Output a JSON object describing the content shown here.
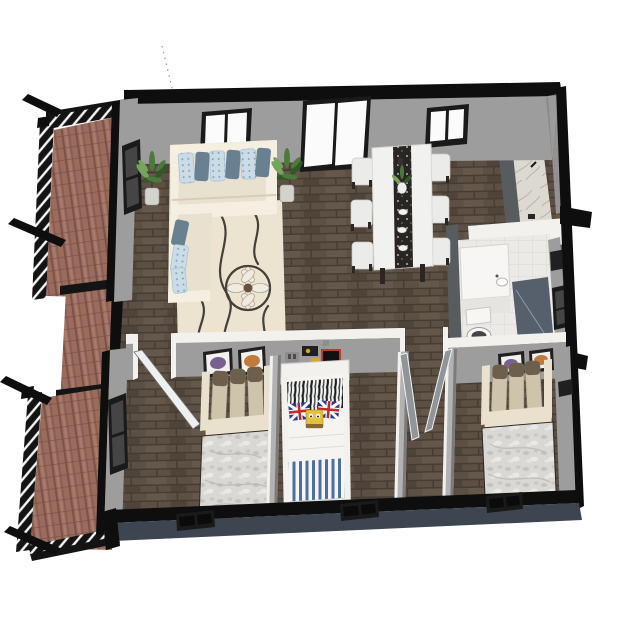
{
  "meta": {
    "description": "3D isometric rendered floor plan of a small apartment, viewed from above on a white background",
    "view": "axonometric top-down 3D render"
  },
  "palette": {
    "bg": "#ffffff",
    "wall_cap": "#0e0e0e",
    "wall_face": "#9d9d9d",
    "wall_face_dark": "#7b7b7b",
    "wall_white": "#f2f1ee",
    "floor_wood": "#5c5044",
    "floor_wood_dark": "#453b31",
    "floor_wood_light": "#6e6052",
    "balcony_floor": "#9a6c5e",
    "balcony_floor_dark": "#764c41",
    "balcony_floor_light": "#b08273",
    "railing": "#141414",
    "railing_slat": "#f7f7f7",
    "exterior_bottom": "#3d4650",
    "window_frame": "#1a1a1a",
    "window_glass": "#fbfbfb",
    "window_glass_dark": "#454545",
    "sofa": "#e9e1cf",
    "sofa_edge": "#f5efe2",
    "sofa_shadow": "#d6ccb8",
    "pillow_print": "#ccdce7",
    "pillow_print_dot": "#7fa3ba",
    "pillow_plain": "#68808f",
    "rug": "#ece4d1",
    "rug_line": "#44403a",
    "flower_petal": "#f0eae0",
    "flower_center": "#6a4e3e",
    "plant": "#4c7a3c",
    "plant_dark": "#34572a",
    "plant_light": "#74a55b",
    "pot": "#d3d3ce",
    "table": "#f1f1ef",
    "runner": "#282522",
    "runner_speck": "#c9ccd0",
    "chair": "#ebebe9",
    "chair_leg": "#2b2622",
    "marble": "#dcd9d2",
    "marble_vein": "#b7b3aa",
    "cabinet": "#595c5f",
    "bath_floor": "#eceae6",
    "tile_line": "#dad8d3",
    "fixture": "#f7f6f4",
    "fixture_shadow": "#e6e4e0",
    "shower_glass": "#4a5562",
    "duvet": "#d9d8d4",
    "duvet_shadow": "#b7b6b1",
    "duvet_light": "#ecebe7",
    "pillow_tan": "#cec3ab",
    "pillow_tan_dark": "#6e5f4c",
    "fold": "#e9e1cd",
    "kid_frame": "#f2f1ed",
    "stripe_blue": "#4e6f9e",
    "stripe_white": "#f4f5f6",
    "zebra_dark": "#1d1d1d",
    "flag_blue": "#2a3a8e",
    "flag_red": "#c22a2a",
    "sponge": "#e4c13d",
    "door_leaf": "#8f9598",
    "door_white": "#eef0f0",
    "art_purple": "#7a5f93",
    "art_orange": "#c07a3d",
    "frame_black": "#202020",
    "decal_yellow": "#d8a728",
    "decal_red": "#c0392b",
    "decal_gray": "#8e8e8e",
    "leader_line": "#9a9a9a"
  },
  "scene": {
    "rooms": [
      {
        "name": "balcony-upper",
        "floor": "red-brown wood planks",
        "features": [
          "black railing with white slats",
          "protruding beams"
        ]
      },
      {
        "name": "balcony-lower",
        "floor": "red-brown wood planks",
        "features": [
          "black railing with white slats",
          "protruding beams"
        ]
      },
      {
        "name": "living-room",
        "floor": "dark wood planks",
        "furniture": [
          "cream corner sofa",
          "blue patterned throw pillows",
          "cream swirl area rug with flower motif",
          "potted plant",
          "potted plant",
          "window",
          "sliding glass door"
        ]
      },
      {
        "name": "dining-room",
        "floor": "dark wood planks",
        "furniture": [
          "white dining table",
          "dark patterned table runner",
          "centerpiece plant",
          "six white chairs",
          "window"
        ]
      },
      {
        "name": "kitchen",
        "furniture": [
          "marble countertop",
          "dark cabinet",
          "cooking pot",
          "small grocery items"
        ]
      },
      {
        "name": "bathroom",
        "floor": "light tile",
        "furniture": [
          "white vanity with sink",
          "toilet",
          "dark glass shower",
          "wall cabinet",
          "window"
        ]
      },
      {
        "name": "bedroom-left",
        "floor": "dark wood planks",
        "furniture": [
          "double bed with gray duvet",
          "three tan pillows",
          "two framed butterfly artworks",
          "window",
          "white door"
        ]
      },
      {
        "name": "kids-room",
        "floor": "dark wood planks",
        "furniture": [
          "white single bed",
          "zebra print pillow",
          "two union-jack pillows",
          "yellow plush toy",
          "blue striped blanket",
          "wall decals"
        ]
      },
      {
        "name": "bedroom-right",
        "floor": "dark wood planks",
        "furniture": [
          "double bed with gray duvet",
          "three tan pillows",
          "two framed butterfly artworks"
        ]
      },
      {
        "name": "hallway",
        "furniture": [
          "open gray double doors"
        ]
      }
    ]
  }
}
